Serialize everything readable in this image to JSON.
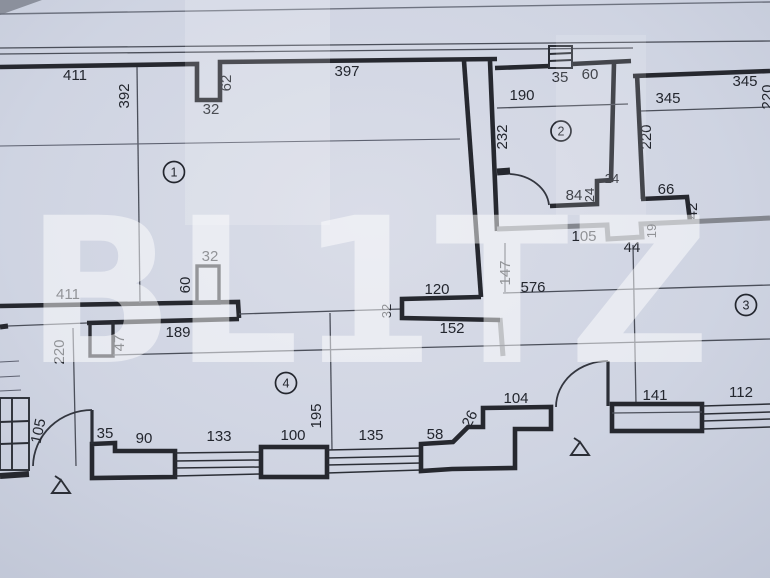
{
  "watermark": {
    "text": "BL1TZ"
  },
  "rooms": {
    "r1": "1",
    "r2": "2",
    "r3": "3",
    "r4": "4"
  },
  "labels": {
    "top_wall_left": "411",
    "room1_height": "392",
    "top_niche_depth": "62",
    "top_niche_width": "32",
    "top_wall_right": "397",
    "r2_top_seg1": "35",
    "r2_top_seg2": "60",
    "r2_width": "190",
    "r2_height": "232",
    "r2_wall_84": "84",
    "r2_step_24v": "24",
    "r2_step_24h": "24",
    "tr_wall_top": "345",
    "tr_width": "345",
    "tr_height": "220",
    "tr_seg_66": "66",
    "tr_step_42": "42",
    "tr_edge_clipped": "220",
    "hall_wall_105": "105",
    "hall_niche_19": "19",
    "hall_niche_44": "44",
    "hall_len_147": "147",
    "hall_len_576": "576",
    "step_120": "120",
    "step_152": "152",
    "step_32v": "32",
    "mid_wall_411": "411",
    "mid_wall_189": "189",
    "mid_niche_32": "32",
    "mid_niche_60": "60",
    "mid_pillar_47": "47",
    "left_dim_220": "220",
    "left_door_105": "105",
    "bottom_35": "35",
    "bottom_90": "90",
    "bottom_window_133": "133",
    "bottom_100": "100",
    "bottom_dim_195": "195",
    "bottom_window_135": "135",
    "bottom_58": "58",
    "bottom_step_26": "26",
    "bottom_104": "104",
    "bottom_141": "141",
    "bottom_window_112": "112"
  }
}
